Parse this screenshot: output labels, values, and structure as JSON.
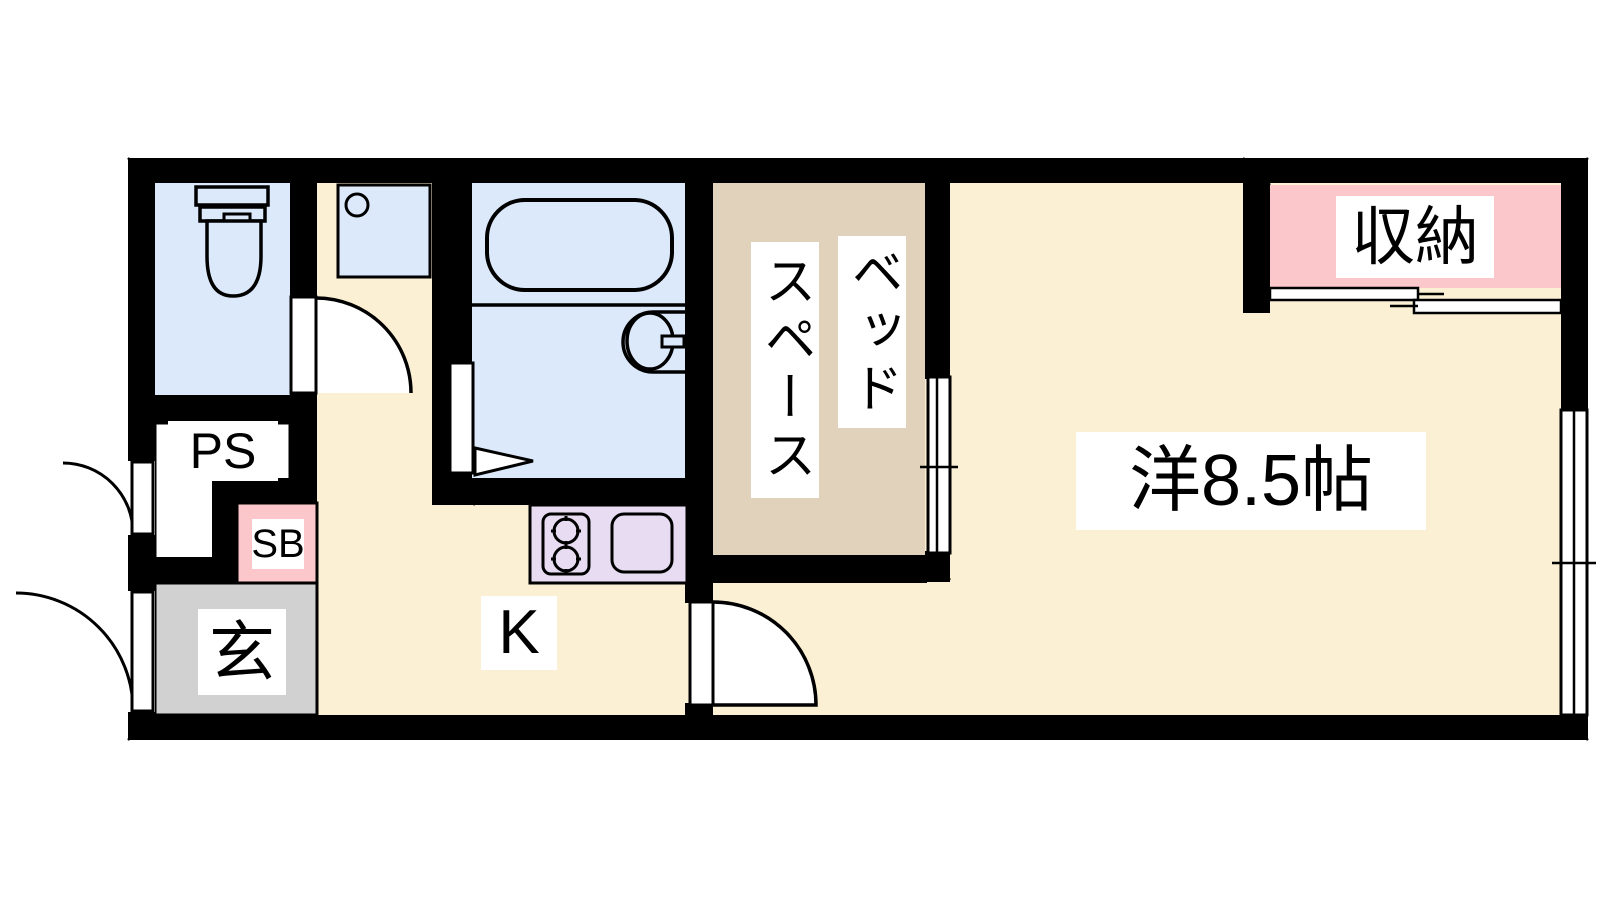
{
  "plan": {
    "type": "apartment-floor-plan",
    "labels": {
      "ps": "PS",
      "sb": "SB",
      "entrance": "玄",
      "kitchen": "K",
      "bed_space_line1": "ベッド",
      "bed_space_line2": "スペース",
      "main_room": "洋8.5帖",
      "storage": "収納"
    },
    "rooms": [
      {
        "name": "toilet-room",
        "fixture": "toilet"
      },
      {
        "name": "pipe-space",
        "label": "PS"
      },
      {
        "name": "shoe-box",
        "label": "SB"
      },
      {
        "name": "entrance-genkan",
        "label": "玄"
      },
      {
        "name": "corridor-washroom",
        "fixture": "washing-machine-pan"
      },
      {
        "name": "bathroom",
        "fixtures": [
          "bathtub",
          "wash-basin"
        ]
      },
      {
        "name": "kitchen",
        "label": "K",
        "fixtures": [
          "gas-stove",
          "kitchen-sink"
        ]
      },
      {
        "name": "bed-space",
        "label": "ベッドスペース"
      },
      {
        "name": "western-room",
        "label": "洋8.5帖",
        "size_tatami": 8.5
      },
      {
        "name": "storage-closet",
        "label": "収納"
      }
    ],
    "openings": [
      {
        "name": "entrance-door",
        "type": "swing-door"
      },
      {
        "name": "ps-door",
        "type": "swing-door"
      },
      {
        "name": "toilet-door",
        "type": "swing-door"
      },
      {
        "name": "bathroom-door",
        "type": "folding-door"
      },
      {
        "name": "kitchen-door",
        "type": "swing-door"
      },
      {
        "name": "closet-sliding-door",
        "type": "sliding-door"
      },
      {
        "name": "bed-space-window",
        "type": "sliding-window"
      },
      {
        "name": "right-wall-window",
        "type": "sliding-window"
      }
    ],
    "colors": {
      "floor_cream": "#FBF0D3",
      "wet_area_blue": "#DCE9FA",
      "bed_space_tan": "#E1D3BB",
      "accent_pink": "#FBC7CA",
      "kitchen_lavender": "#E7DCF2",
      "entrance_gray": "#D1D1D1",
      "wall_black": "#000000"
    }
  }
}
